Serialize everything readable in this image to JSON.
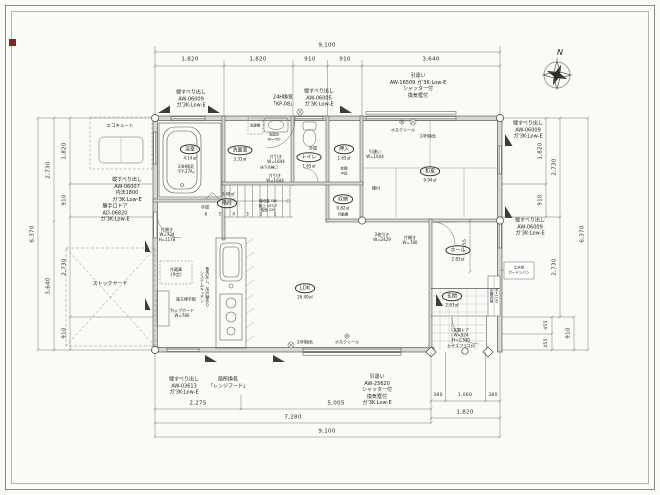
{
  "colors": {
    "paper": "#fbfaf7",
    "ink": "#3a3a36",
    "red": "#7b2727"
  },
  "compass": {
    "label": "N"
  },
  "dims": {
    "top": {
      "total": "9,100",
      "s1": "1,820",
      "s2": "1,820",
      "s3": "910",
      "s4": "910",
      "s5": "3,640"
    },
    "bottom": {
      "a": "2,275",
      "b": "5,005",
      "c": "7,280",
      "total": "9,100",
      "r1": "380",
      "r2": "1,060",
      "r3": "380",
      "rt": "1,820"
    },
    "left": {
      "outer": "6,370",
      "m1": "2,730",
      "m2": "3,640",
      "i1": "1,820",
      "i2": "910",
      "i3": "2,730",
      "i4": "910"
    },
    "right": {
      "outer": "6,370",
      "m1": "2,730",
      "m2": "2,730",
      "i1": "1,820",
      "i2": "910",
      "l1": "455",
      "l2": "455",
      "l3": "910",
      "hall": "1,555"
    }
  },
  "rooms": {
    "bath": {
      "name": "浴室",
      "area": "4.14㎡",
      "vent": "24H換気\n「FY-27A」"
    },
    "wash": {
      "name": "洗面室",
      "area": "3.31㎡"
    },
    "toilet": {
      "name": "トイレ",
      "area": "1.65㎡",
      "note": "手摺"
    },
    "oshiire": {
      "name": "押入",
      "area": "1.65㎡",
      "note": "枕棚\n中段"
    },
    "washitsu": {
      "name": "和室",
      "area": "9.94㎡",
      "note": "棚付"
    },
    "closet": {
      "name": "収納",
      "area": "0.82㎡",
      "note": "可動棚"
    },
    "stairs": {
      "name": "階段",
      "area": "3.48㎡",
      "spec": "階段幅 780\n蹴上 193.7\n踏面 220",
      "steps": "6 5 4 3 2 1",
      "rail": "手摺"
    },
    "ldk": {
      "name": "LDK",
      "area": "26.49㎡"
    },
    "hall": {
      "name": "ホール",
      "area": "2.83㎡"
    },
    "genkan": {
      "name": "玄関",
      "area": "2.63㎡"
    }
  },
  "openings": {
    "win_top_left": "縦すべり出し\nAW-06009\nガ'3K:Low-E",
    "vent_top": "24H換気\n「KP-08」",
    "win_top_mid": "縦すべり出し\nAW-06005\nガ'3K:Low-E",
    "win_top_right": "引違い\nAW-16509 ガ'3K:Low-E\nシャッター付\n換気框付",
    "win_right_upper": "縦すべり出し\nAW-06009\nガ'3K:Low-E",
    "win_right_lower": "縦すべり出し\nAW-06009\nガ'3K:Low-E",
    "win_left": "縦すべり出し\nAW-06007\n内法1800\nガ'3K:Low-E",
    "door_back": "勝手口ドア\nAD-06820\nガ'3K:Low-E",
    "win_bottom_left": "縦すべり出し\nAW-03613\nガ'3K:Low-E",
    "vent_bottom": "局所換気\n「レンジフード」",
    "win_bottom_right": "引違い\nAW-25620\nシャッター付\n換気框付\nガ'3K:Low-E",
    "slide1": "片引き\nW=1644",
    "slide2": "片引き\nW=1644",
    "slide_washitsu": "引違い\nW=1644",
    "slide2mai": "2枚引き\nW=2429",
    "door_washitsu": "片開き\nW=780",
    "door_inner": "片開き\nW=734\nH=1178",
    "door_entry": "玄関ドア\nW=924\nH=2,330\nカザスプラス付"
  },
  "equipment": {
    "ecocute": "エコキュート",
    "stockyard": "ストックヤード",
    "hosu_top": "ホスクリール",
    "vent24_top": "24H換気",
    "hosu_bottom": "ホスクリール",
    "vent24_bottom": "24H換気",
    "fridge": "冷蔵庫\n(予定)",
    "owner": "施主様手配",
    "cupboard": "カップボード\nW=780",
    "kitchen": "システムキッチン\n食洗なし、吊戸棚あり",
    "washbasin": "洗面台\nW=750",
    "washer": "洗濯機",
    "hatch": "床下点検口",
    "shoe": "玄関収納\nW=1100",
    "water": "立水栓\nガーデンパン"
  }
}
